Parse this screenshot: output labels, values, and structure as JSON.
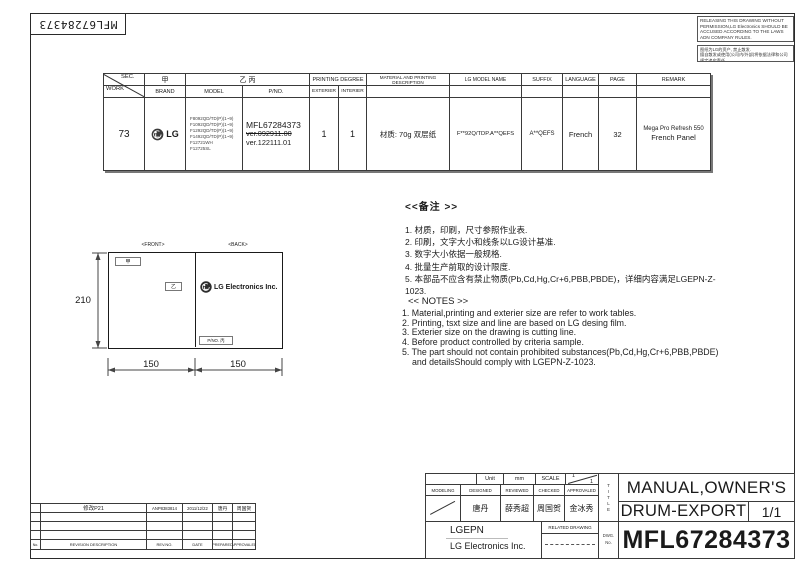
{
  "sheet": {
    "barcode_label": "MFL67284373",
    "warning_en": "RELEASING THIS DRAWING WITHOUT PERMISSION,LG Electronics SHOULD BE ACCUSED ACCORDING TO THE LAWS ADN COMPANY RULES.",
    "warning_cn_line1": "图纸为LG的资产, 禁止散发.",
    "warning_cn_line2": "擅自散发或使用(公司内/外部)将依据法律和公司规定追究责任"
  },
  "spec_table": {
    "sec_label": "SEC.",
    "work_label": "WORK",
    "jia": "甲",
    "yi_bing": "乙 丙",
    "printing_degree": "PRINTING DEGREE",
    "brand_label": "BRAND",
    "model_label": "MODEL",
    "pno_label": "P/NO.",
    "exterier_label": "EXTERIER",
    "interier_label": "INTERIER",
    "material_label": "MATERIAL AND PRINTING DESCRIPTION",
    "lg_model_label": "LG MODEL NAME",
    "suffix_label": "SUFFIX",
    "language_label": "LANGUAGE",
    "page_label": "PAGE",
    "remark_label": "REMARK",
    "row": {
      "work": "73",
      "brand": "LG",
      "models": [
        "F8092QD/TD(P)(1~9)",
        "F1092QD/TD(P)(1~9)",
        "F1292QD/TD(P)(1~9)",
        "F1492QD/TD(P)(1~9)",
        "F12721WH",
        "F12725SL"
      ],
      "pno": "MFL67284373",
      "pno_old_ver": "ver.092911.00",
      "pno_new_ver": "ver.122111.01",
      "exterier": "1",
      "interier": "1",
      "material": "材质: 70g 双层纸",
      "lg_model_name": "F**92Q/TDP.A**QEFS",
      "suffix": "A**QEFS",
      "language": "French",
      "page": "32",
      "remark_line1": "Mega Pro Refresh 550",
      "remark_line2": "French   Panel"
    }
  },
  "notes_cn": {
    "title": "<<备注 >>",
    "items": [
      "1.  材质，印刷，尺寸参照作业表.",
      "2.  印刷，文字大小和线条以LG设计基准.",
      "3.  数字大小依据一般规格.",
      "4.  批量生产前取的设计限度.",
      "5.  本部品不应含有禁止物质(Pb,Cd,Hg,Cr+6,PBB,PBDE)，详细内容满足LGEPN-Z-1023."
    ]
  },
  "notes_en": {
    "title": "<< NOTES >>",
    "items": [
      "1. Material,printing and exterier size are refer to work tables.",
      "2. Printing, tsxt  size and line are based on LG desing film.",
      "3. Exterier size on the drawing is cutting line.",
      "4. Before product controlled by criteria sample.",
      "5. The part should not contain prohibited substances(Pb,Cd,Hg,Cr+6,PBB,PBDE)",
      "and detailsShould comply with LGEPN-Z-1023."
    ]
  },
  "drawing": {
    "front_label": "<FRONT>",
    "back_label": "<BACK>",
    "height_dim": "210",
    "front_width_dim": "150",
    "back_width_dim": "150",
    "front_box_top": "甲",
    "front_box_mid": "乙",
    "back_logo_text": "LG Electronics Inc.",
    "back_pno_box": "P/NO. 丙"
  },
  "revision_table": {
    "row1": {
      "description": "修改P21",
      "rev_no": "ANP8383814",
      "date": "2011/12/22",
      "prepared": "唐丹",
      "approved": "周国贺"
    },
    "footer": {
      "no": "No.",
      "description": "REVISION DESCRIPTION",
      "rev_no": "REV.NO.",
      "date": "DATE",
      "prepared": "PREPARED",
      "approved": "APPROVALED"
    }
  },
  "title_block": {
    "unit_label": "Unit",
    "unit_value": "mm",
    "scale_label": "SCALE",
    "scale_top": "1",
    "scale_bottom": "1",
    "modeling_label": "MODELING",
    "designed_label": "DESIGNED",
    "reviewed_label": "REVIEWED",
    "checked_label": "CHECKED",
    "approvaled_label": "APPROVALED",
    "designed_name": "唐丹",
    "reviewed_name": "薛秀超",
    "checked_name": "周国贺",
    "approvaled_name": "金冰秀",
    "company_short": "LGEPN",
    "company_full": "LG Electronics Inc.",
    "related_drawing_label": "RELATED DRAWING",
    "dwg_label": "DWG.",
    "dwg_no_label": "No.",
    "title_vertical": "TITLE",
    "title_line1": "MANUAL,OWNER'S",
    "title_line2": "DRUM-EXPORT",
    "sheet_no": "1/1",
    "dwg_number": "MFL67284373"
  }
}
